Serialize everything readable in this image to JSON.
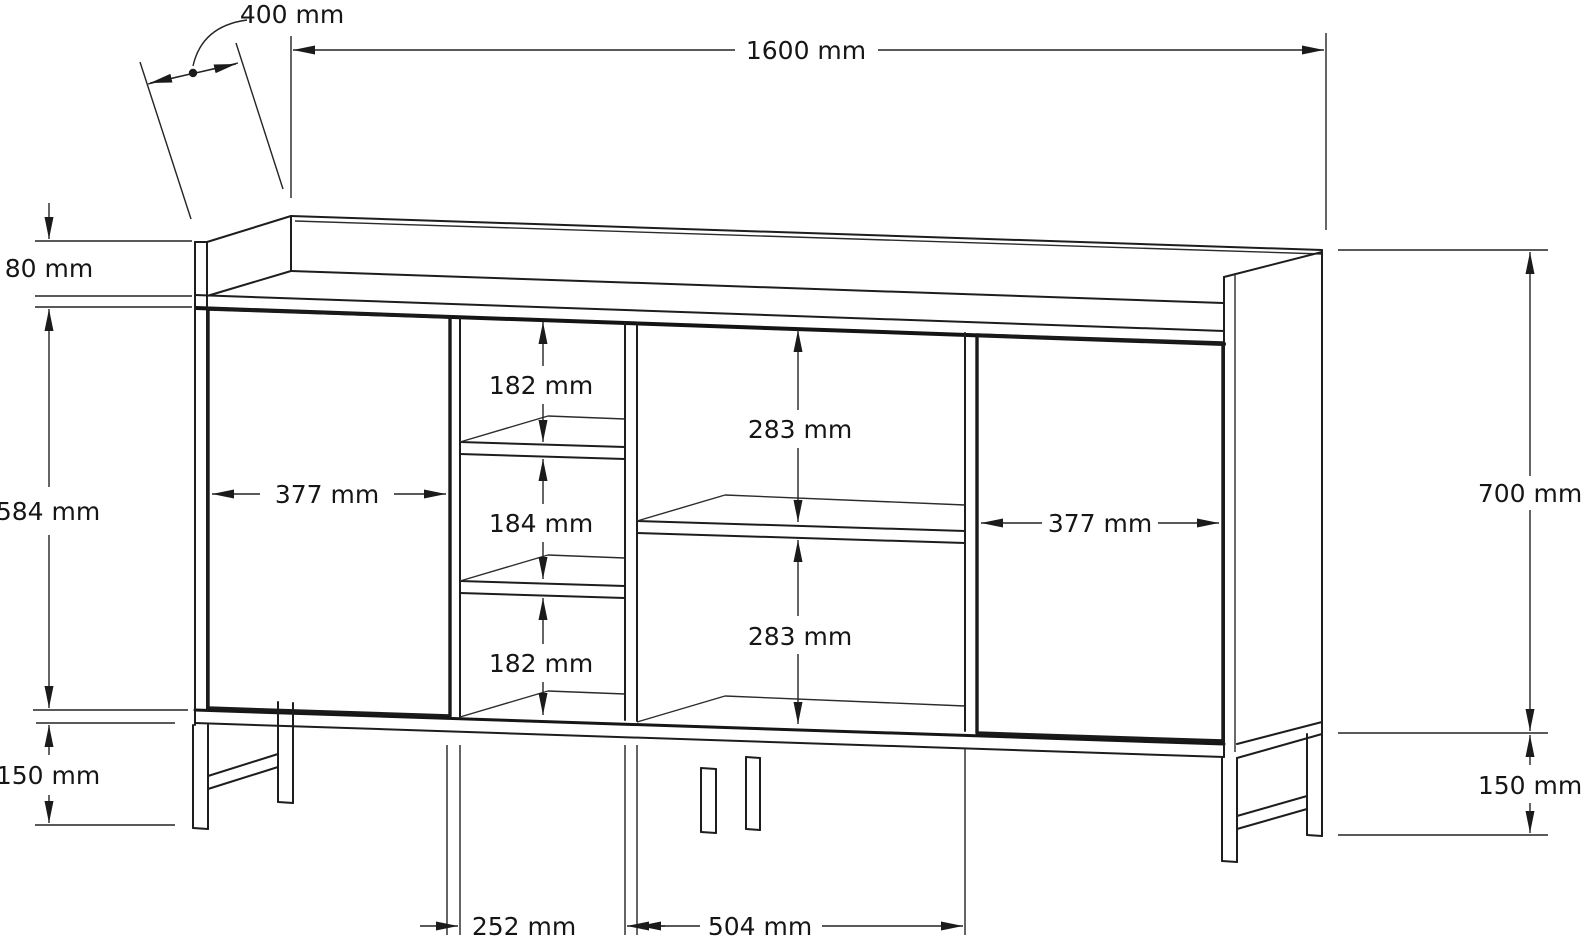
{
  "drawing": {
    "units": "mm",
    "dims": {
      "d400": {
        "label": "400 mm",
        "value": 400,
        "meaning": "depth of cabinet"
      },
      "d1600": {
        "label": "1600 mm",
        "value": 1600,
        "meaning": "overall width"
      },
      "d80": {
        "label": "80 mm",
        "value": 80,
        "meaning": "back rail height above top"
      },
      "d584": {
        "label": "584 mm",
        "value": 584,
        "meaning": "carcass front height"
      },
      "d150_left": {
        "label": "150 mm",
        "value": 150,
        "meaning": "leg height left"
      },
      "d182_top": {
        "label": "182 mm",
        "value": 182,
        "meaning": "upper cubby height"
      },
      "d184": {
        "label": "184 mm",
        "value": 184,
        "meaning": "middle cubby height"
      },
      "d182_bottom": {
        "label": "182 mm",
        "value": 182,
        "meaning": "lower cubby height"
      },
      "d377_left": {
        "label": "377 mm",
        "value": 377,
        "meaning": "left door width"
      },
      "d283_top": {
        "label": "283 mm",
        "value": 283,
        "meaning": "open shelf upper height"
      },
      "d283_bottom": {
        "label": "283 mm",
        "value": 283,
        "meaning": "open shelf lower height"
      },
      "d377_right": {
        "label": "377 mm",
        "value": 377,
        "meaning": "right door width"
      },
      "d700": {
        "label": "700 mm",
        "value": 700,
        "meaning": "cabinet body height"
      },
      "d150_right": {
        "label": "150 mm",
        "value": 150,
        "meaning": "leg height right"
      },
      "d252": {
        "label": "252 mm",
        "value": 252,
        "meaning": "center column width"
      },
      "d504": {
        "label": "504 mm",
        "value": 504,
        "meaning": "open compartment width"
      }
    }
  }
}
